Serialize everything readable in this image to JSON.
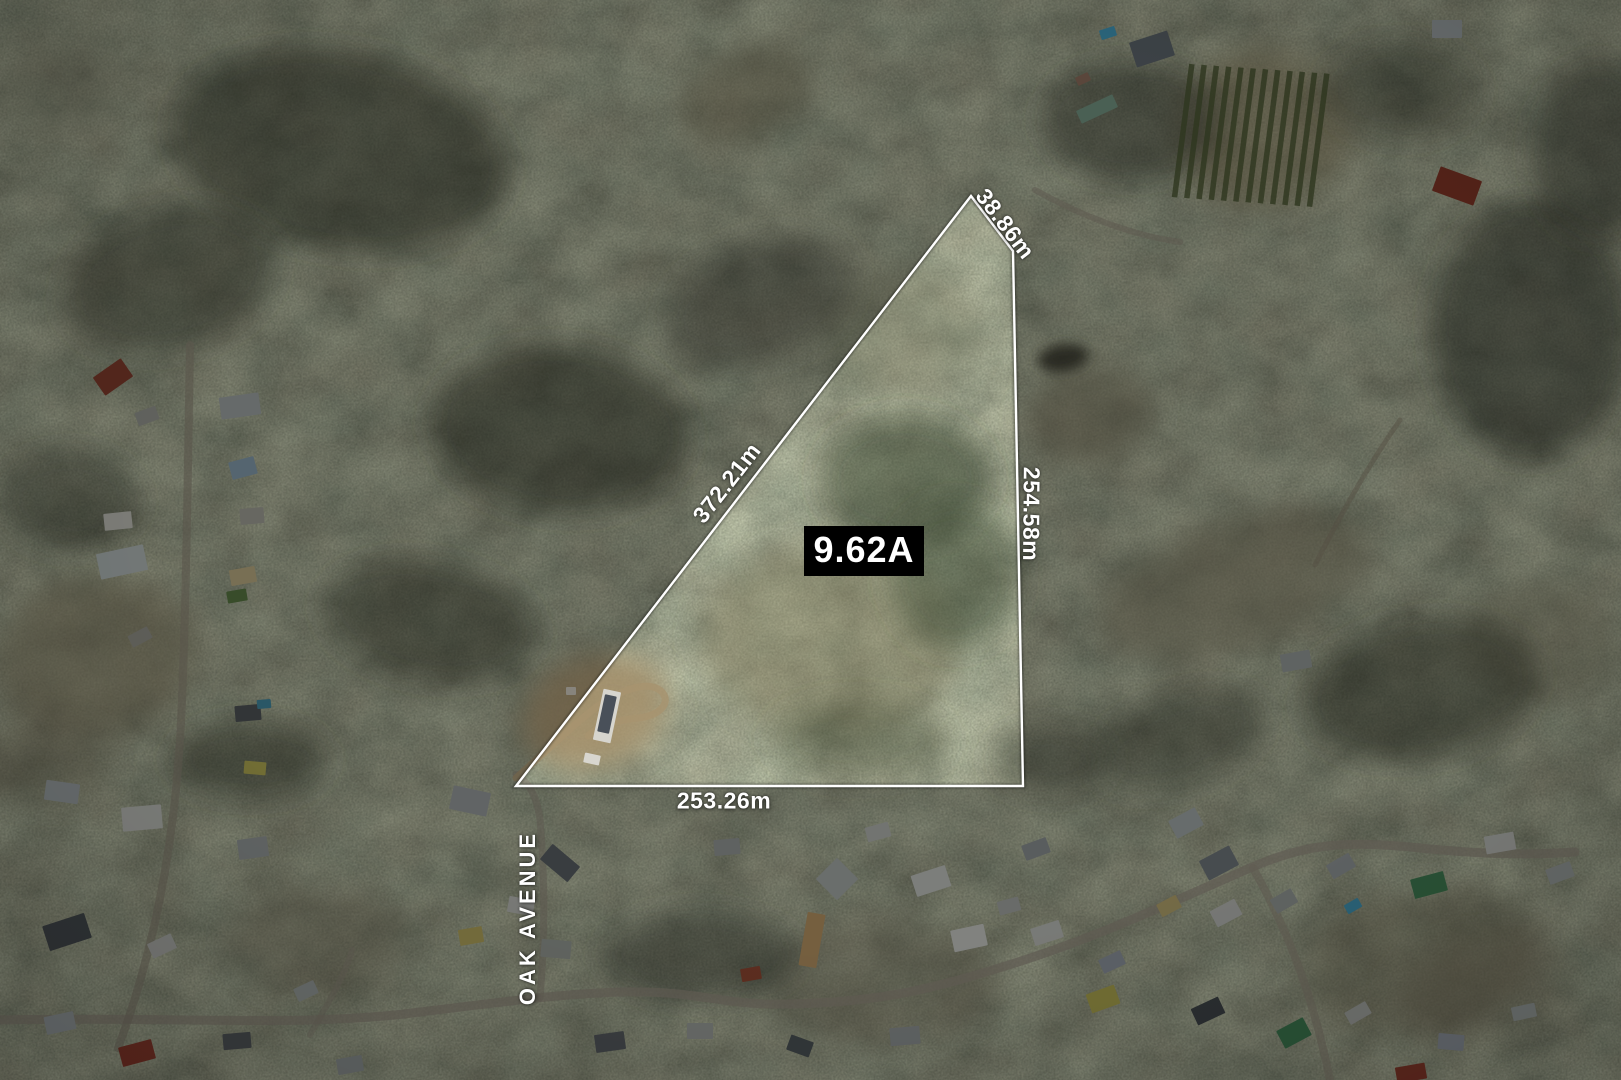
{
  "property_map": {
    "description": "aerial-photo-with-parcel-overlay",
    "area_label": "9.62A",
    "street_name": "OAK AVENUE",
    "label_color": "#ffffff",
    "area_box": {
      "bg": "#000000",
      "text_color": "#ffffff"
    },
    "boundary": {
      "stroke_color": "#ffffff",
      "vertices_px": [
        [
          971,
          196
        ],
        [
          1013,
          251
        ],
        [
          1023,
          786
        ],
        [
          516,
          786
        ]
      ]
    },
    "dimensions": {
      "top": "38.86m",
      "diagonal": "372.21m",
      "right": "254.58m",
      "bottom": "253.26m"
    }
  }
}
